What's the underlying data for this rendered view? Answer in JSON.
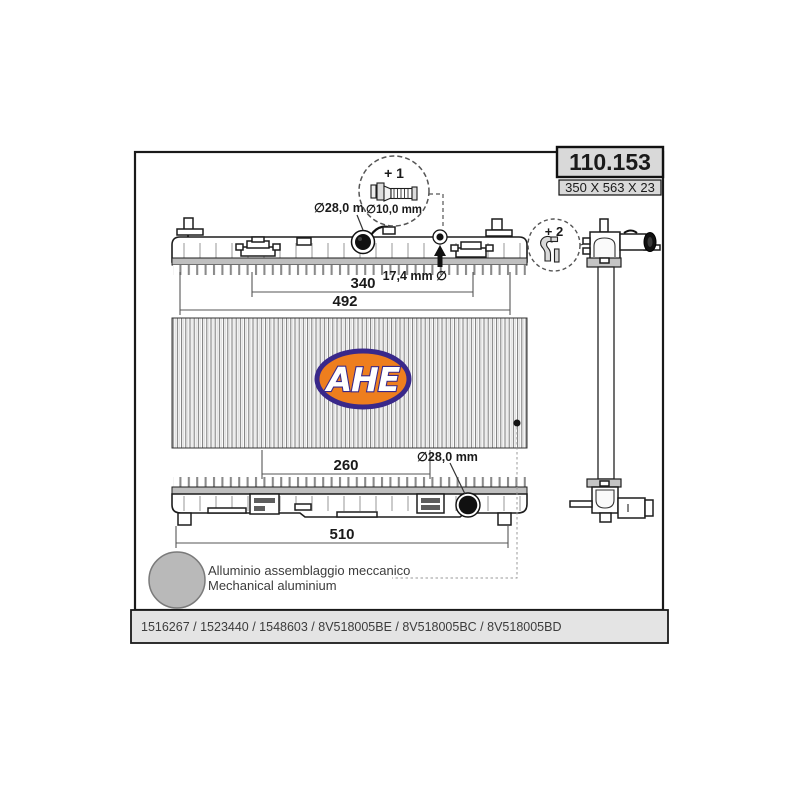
{
  "title_block": {
    "part_number": "110.153",
    "size": "350 X 563 X 23"
  },
  "labels": {
    "detail_1": "+ 1",
    "detail_1_diameter": "∅10,0 mm",
    "detail_2": "+ 2",
    "inlet_diameter_top": "∅28,0 mm",
    "filler_neck_diameter": "17,4 mm ∅",
    "outlet_diameter_bottom": "∅28,0 mm"
  },
  "dimensions": {
    "top_inner": "340",
    "top_outer": "492",
    "bottom_inner": "260",
    "bottom_outer": "510"
  },
  "logo": {
    "text": "AHE"
  },
  "material": {
    "line_it": "Alluminio assemblaggio meccanico",
    "line_en": "Mechanical aluminium"
  },
  "footer": {
    "oe_numbers": "1516267 / 1523440 / 1548603 / 8V518005BE / 8V518005BC / 8V518005BD"
  },
  "colors": {
    "logo_orange": "#EE7E1E",
    "logo_blue": "#39288A",
    "title_box_bg": "#D9D9D9",
    "footer_bg": "#E4E4E4",
    "crimp_band": "#BFBFBF",
    "material_circle": "#B9B9B9",
    "port_black": "#111111"
  }
}
